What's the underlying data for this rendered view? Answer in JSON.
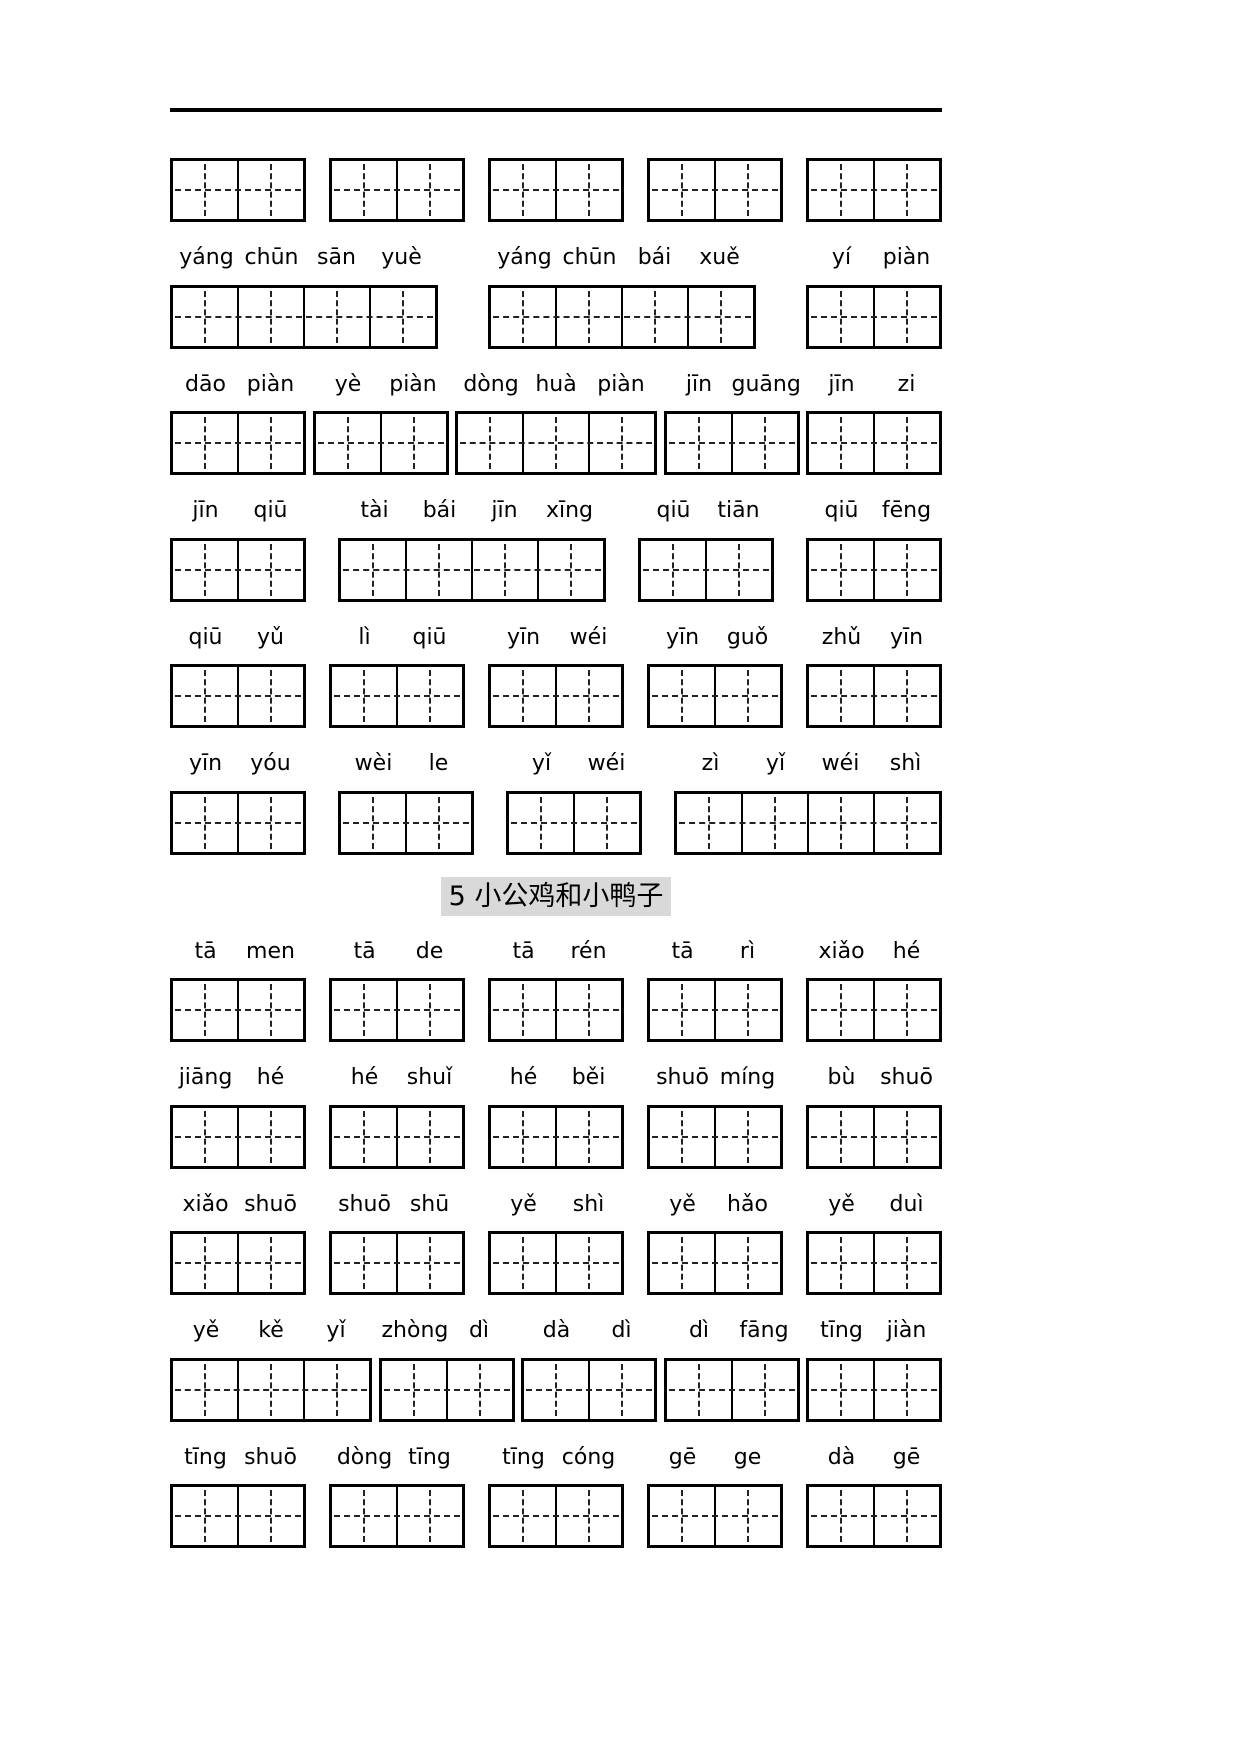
{
  "colors": {
    "ink": "#000000",
    "title_highlight": "#d9d9d9"
  },
  "title": {
    "text": "5 小公鸡和小鸭子"
  },
  "orphan_grid_row": [
    2,
    2,
    2,
    2,
    2
  ],
  "sections_before_title": [
    {
      "pinyin": [
        [
          "yáng",
          "chūn",
          "sān",
          "yuè"
        ],
        [
          "yáng",
          "chūn",
          "bái",
          "xuě"
        ],
        [
          "yí",
          "piàn"
        ]
      ],
      "boxes": [
        4,
        4,
        2
      ]
    },
    {
      "pinyin": [
        [
          "dāo",
          "piàn"
        ],
        [
          "yè",
          "piàn"
        ],
        [
          "dòng",
          "huà",
          "piàn"
        ],
        [
          "jīn",
          "guāng"
        ],
        [
          "jīn",
          "zi"
        ]
      ],
      "boxes": [
        2,
        2,
        3,
        2,
        2
      ]
    },
    {
      "pinyin": [
        [
          "jīn",
          "qiū"
        ],
        [
          "tài",
          "bái",
          "jīn",
          "xīng"
        ],
        [
          "qiū",
          "tiān"
        ],
        [
          "qiū",
          "fēng"
        ]
      ],
      "boxes": [
        2,
        4,
        2,
        2
      ]
    },
    {
      "pinyin": [
        [
          "qiū",
          "yǔ"
        ],
        [
          "lì",
          "qiū"
        ],
        [
          "yīn",
          "wéi"
        ],
        [
          "yīn",
          "guǒ"
        ],
        [
          "zhǔ",
          "yīn"
        ]
      ],
      "boxes": [
        2,
        2,
        2,
        2,
        2
      ]
    },
    {
      "pinyin": [
        [
          "yīn",
          "yóu"
        ],
        [
          "wèi",
          "le"
        ],
        [
          "yǐ",
          "wéi"
        ],
        [
          "zì",
          "yǐ",
          "wéi",
          "shì"
        ]
      ],
      "boxes": [
        2,
        2,
        2,
        4
      ]
    }
  ],
  "sections_after_title": [
    {
      "pinyin": [
        [
          "tā",
          "men"
        ],
        [
          "tā",
          "de"
        ],
        [
          "tā",
          "rén"
        ],
        [
          "tā",
          "rì"
        ],
        [
          "xiǎo",
          "hé"
        ]
      ],
      "boxes": [
        2,
        2,
        2,
        2,
        2
      ]
    },
    {
      "pinyin": [
        [
          "jiāng",
          "hé"
        ],
        [
          "hé",
          "shuǐ"
        ],
        [
          "hé",
          "běi"
        ],
        [
          "shuō",
          "míng"
        ],
        [
          "bù",
          "shuō"
        ]
      ],
      "boxes": [
        2,
        2,
        2,
        2,
        2
      ]
    },
    {
      "pinyin": [
        [
          "xiǎo",
          "shuō"
        ],
        [
          "shuō",
          "shū"
        ],
        [
          "yě",
          "shì"
        ],
        [
          "yě",
          "hǎo"
        ],
        [
          "yě",
          "duì"
        ]
      ],
      "boxes": [
        2,
        2,
        2,
        2,
        2
      ]
    },
    {
      "pinyin": [
        [
          "yě",
          "kě",
          "yǐ"
        ],
        [
          "zhòng",
          "dì"
        ],
        [
          "dà",
          "dì"
        ],
        [
          "dì",
          "fāng"
        ],
        [
          "tīng",
          "jiàn"
        ]
      ],
      "boxes": [
        3,
        2,
        2,
        2,
        2
      ]
    },
    {
      "pinyin": [
        [
          "tīng",
          "shuō"
        ],
        [
          "dòng",
          "tīng"
        ],
        [
          "tīng",
          "cóng"
        ],
        [
          "gē",
          "ge"
        ],
        [
          "dà",
          "gē"
        ]
      ],
      "boxes": [
        2,
        2,
        2,
        2,
        2
      ]
    }
  ]
}
